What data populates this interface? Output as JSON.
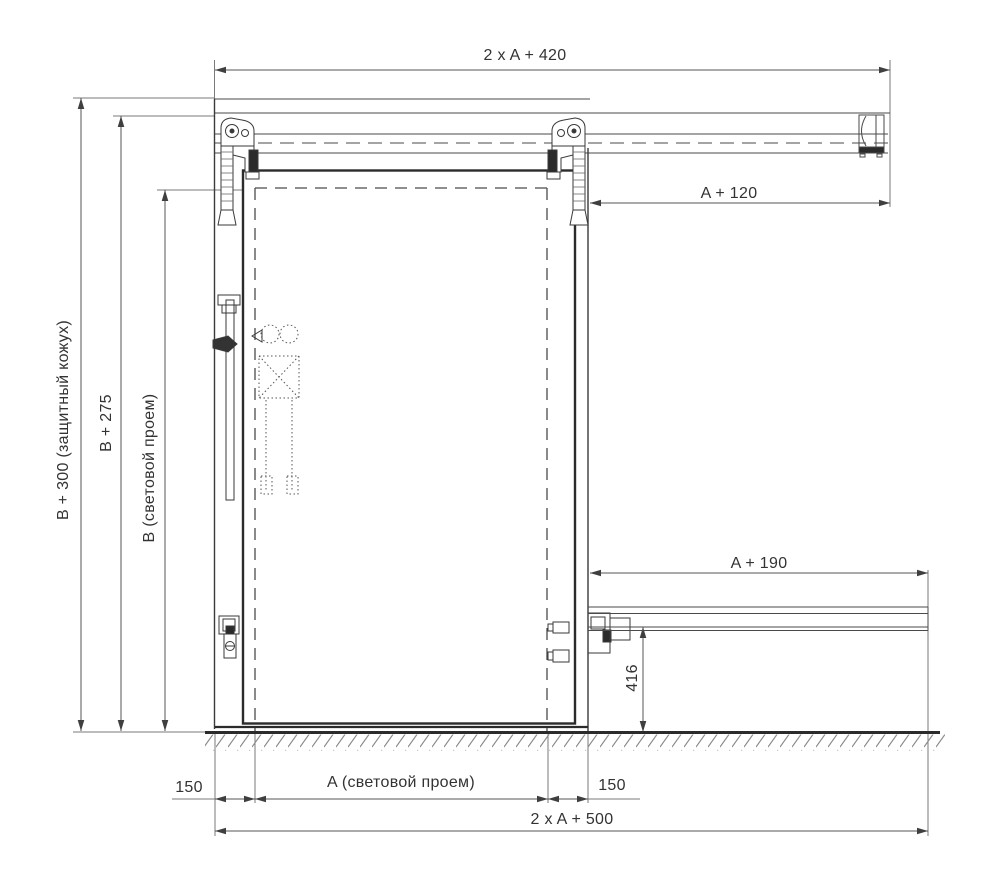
{
  "page": {
    "background": "#ffffff",
    "line_color": "#3f3f3f",
    "text_color": "#333333"
  },
  "drawing": {
    "kind": "sliding-door-installation-diagram"
  },
  "labels": {
    "dim_top_width": "2 x A + 420",
    "dim_track_right": "A + 120",
    "dim_lower_track": "A + 190",
    "dim_guide_height": "416",
    "dim_total_height": "B + 300 (защитный кожух)",
    "dim_track_height": "B + 275",
    "dim_opening_height": "B (световой проем)",
    "dim_overlap_left": "150",
    "dim_opening_width": "A (световой проем)",
    "dim_overlap_right": "150",
    "dim_total_width": "2 x A + 500"
  }
}
